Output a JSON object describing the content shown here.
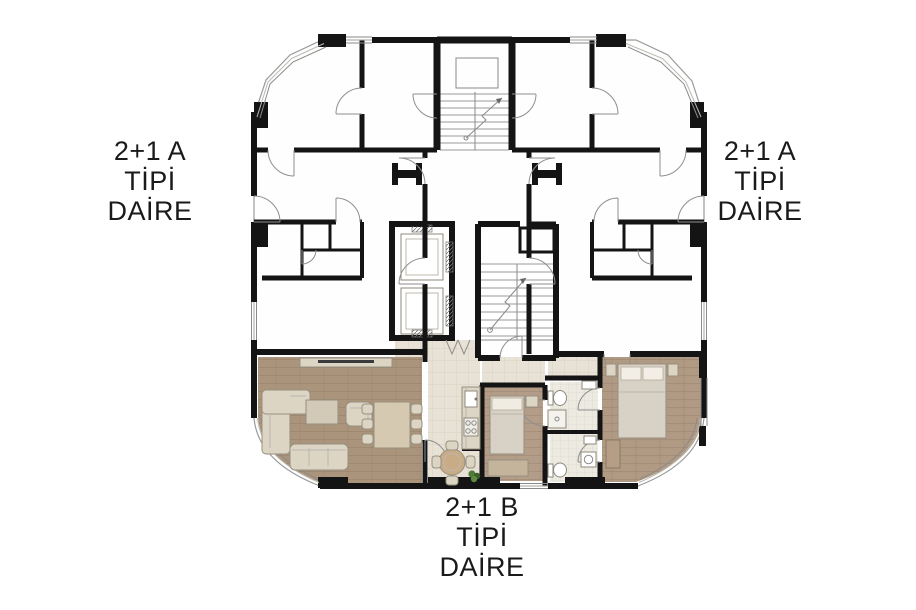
{
  "labels": {
    "left": {
      "lines": [
        "2+1 A",
        "TİPİ",
        "DAİRE"
      ]
    },
    "right": {
      "lines": [
        "2+1 A",
        "TİPİ",
        "DAİRE"
      ]
    },
    "bottom": {
      "lines": [
        "2+1 B",
        "TİPİ",
        "DAİRE"
      ]
    }
  },
  "colors": {
    "wall": "#141414",
    "text": "#1a1a1a",
    "floor_living": "#ab947c",
    "floor_bedroom": "#b09a84",
    "floor_bedroom_small": "#b39d88",
    "floor_tile": "#e8e2d6",
    "tile_grid": "#d8d1c3",
    "floor_bath": "#edeae2",
    "furniture": "#ddd5c4",
    "furniture_stroke": "#96907f",
    "bed": "#d8d1c5",
    "wood": "#c9ab86",
    "wardrobe": "#b59e85",
    "plant": "#4f7a38"
  }
}
